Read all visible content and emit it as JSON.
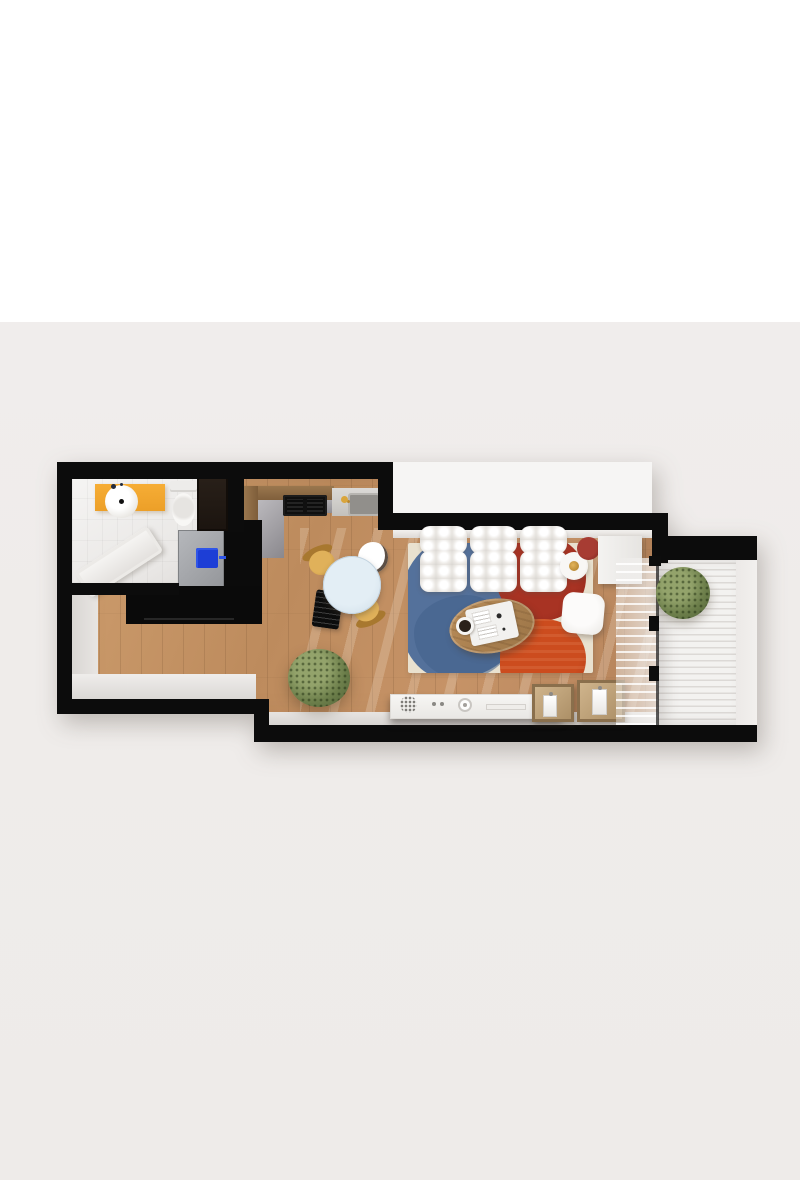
{
  "scene": {
    "description": "Top-down 3D rendered floor plan of a small apartment on a light grey backdrop",
    "background_top_color": "#ffffff",
    "backdrop_color": "#efecea",
    "wall_color": "#0c0c0c",
    "wood_floor_color": "#c29264",
    "bath_tile_color": "#f0eeec",
    "balcony_deck_color": "#f3f2f0"
  },
  "palette": {
    "accent_orange_vanity": "#f6ad35",
    "washer_door_blue": "#1d3ed6",
    "dining_table_blue": "#d9e6ef",
    "chair_yellow": "#d9a84e",
    "rug_cream": "#e9e1cf",
    "rug_blue": "#54719b",
    "rug_red_dark": "#a83323",
    "rug_red_bright": "#cc4c1e",
    "sofa_white": "#f6f5f3",
    "coffee_table_wood": "#b88c59",
    "crate_wood": "#c9a87c",
    "plant_green": "#6d7f4b"
  },
  "rooms": [
    {
      "name": "bathroom",
      "items": [
        "orange vanity with round vessel sink",
        "black faucet",
        "toilet",
        "dark tall cabinet",
        "angled bathtub",
        "white tile floor"
      ]
    },
    {
      "name": "utility-kitchen",
      "items": [
        "washing machine with blue door",
        "black tall column cabinet",
        "black lower cabinet run",
        "L-shaped counter with grey inner top",
        "black cooktop",
        "sink with gold faucet"
      ]
    },
    {
      "name": "dining-area",
      "items": [
        "round pale-blue table",
        "two yellow chairs",
        "white chair with dark rim",
        "black slatted chair"
      ]
    },
    {
      "name": "living-room",
      "items": [
        "white tufted three-seat sofa",
        "abstract rug cream blue red",
        "oval wooden coffee table",
        "white tray with magazines",
        "black coffee cup on saucer",
        "white square pouf",
        "floor lamp white disc gold center",
        "dark red lamp disc",
        "white side console",
        "white media sideboard with decor",
        "two wooden crates with bottles",
        "green potted plant"
      ]
    },
    {
      "name": "balcony",
      "items": [
        "white slatted decking",
        "green plant",
        "sliding glass door",
        "sheer curtain"
      ]
    }
  ]
}
